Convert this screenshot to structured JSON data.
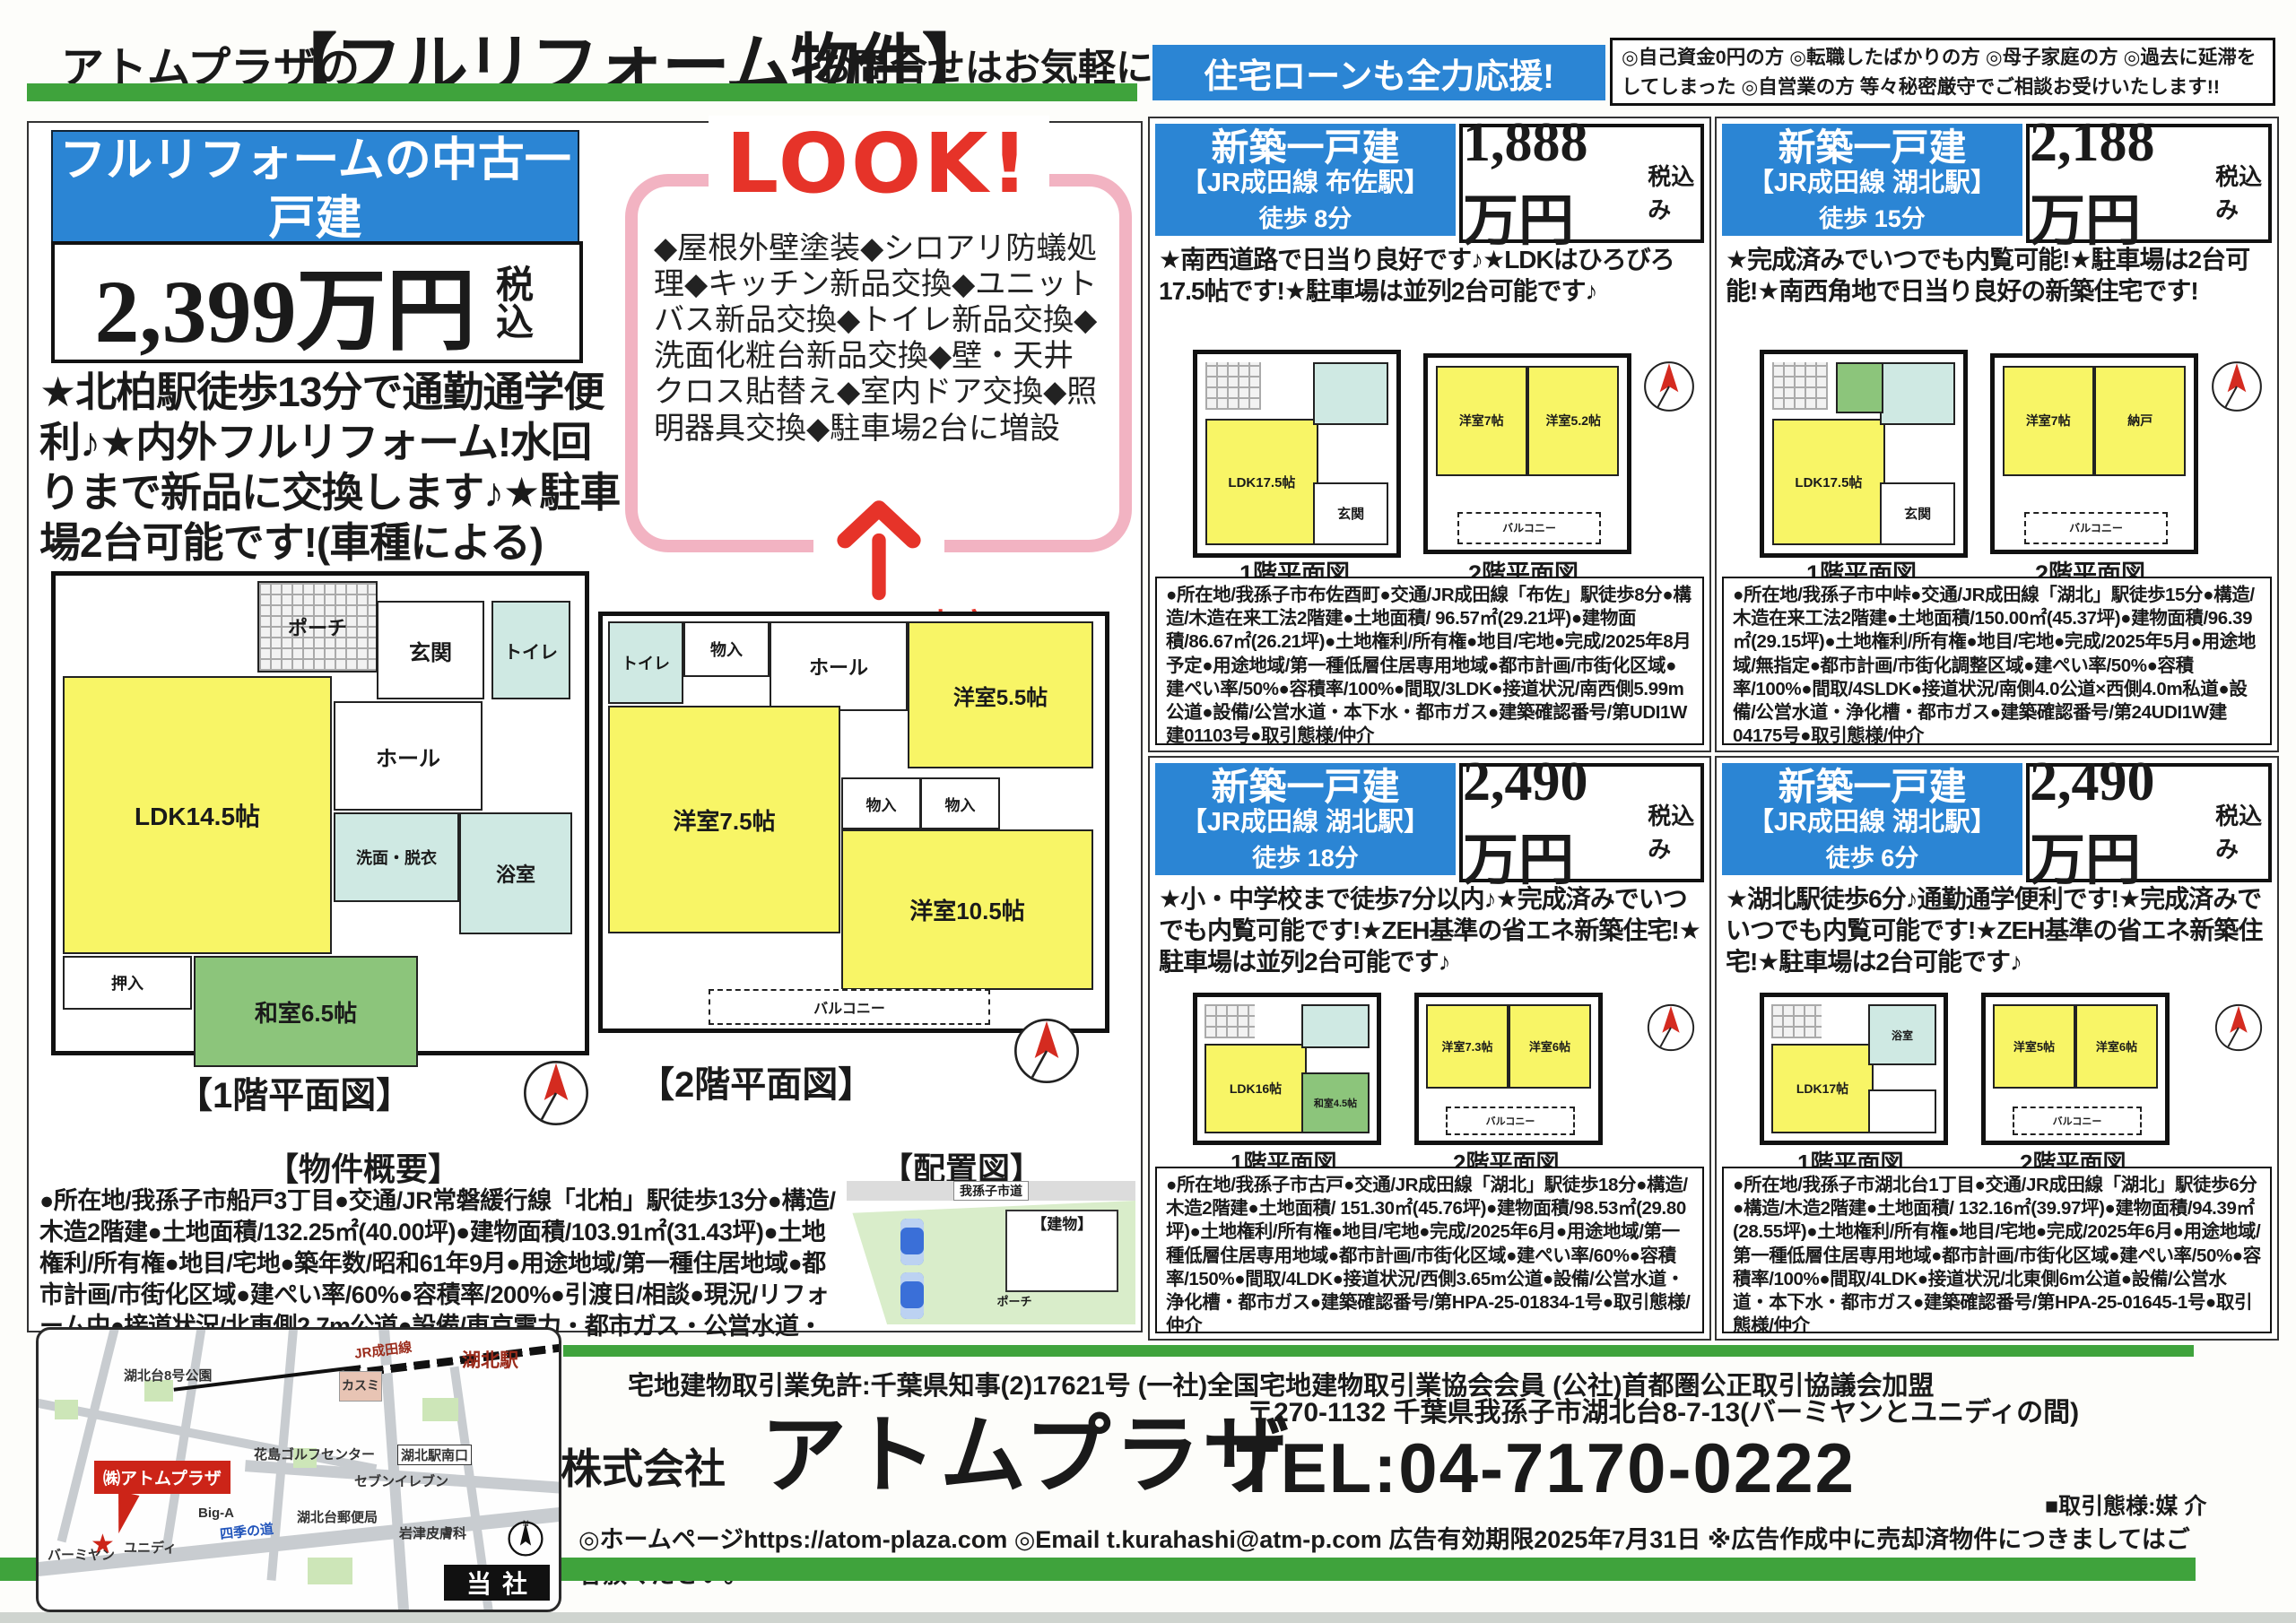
{
  "header": {
    "brand_prefix": "アトムプラザの",
    "title": "【フルリフォーム物件】",
    "subtitle": "お問合せはお気軽に!"
  },
  "loan_banner": {
    "label": "住宅ローンも全力応援!",
    "text": "◎自己資金0円の方 ◎転職したばかりの方 ◎母子家庭の方 ◎過去に延滞をしてしまった ◎自営業の方 等々秘密厳守でご相談お受けいたします!!"
  },
  "main_property": {
    "header": "フルリフォームの中古一戸建",
    "access": "【JR常磐緩行線 北柏駅 徒歩 13分】",
    "price": "2,399万円",
    "tax_note": "税込",
    "features": "★北柏駅徒歩13分で通勤通学便利♪★内外フルリフォーム!水回りまで新品に交換します♪★駐車場2台可能です!(車種による)",
    "look": {
      "badge": "LOOK!",
      "items": "◆屋根外壁塗装◆シロアリ防蟻処理◆キッチン新品交換◆ユニットバス新品交換◆トイレ新品交換◆洗面化粧台新品交換◆壁・天井クロス貼替え◆室内ドア交換◆照明器具交換◆駐車場2台に増設",
      "caption": "リフォーム内容!"
    },
    "floor1_label": "【1階平面図】",
    "floor2_label": "【2階平面図】",
    "overview_label": "【物件概要】",
    "layout_label": "【配置図】",
    "overview": "●所在地/我孫子市船戸3丁目●交通/JR常磐緩行線「北柏」駅徒歩13分●構造/木造2階建●土地面積/132.25㎡(40.00坪)●建物面積/103.91㎡(31.43坪)●土地権利/所有権●地目/宅地●築年数/昭和61年9月●用途地域/第一種住居地域●都市計画/市街化区域●建ぺい率/60%●容積率/200%●引渡日/相談●現況/リフォーム中●接道状況/北東側2.7m公道●設備/東京電力・都市ガス・公営水道・本下水●取引態様/仲介",
    "floor1_rooms": [
      "ポーチ",
      "玄関",
      "トイレ",
      "ホール",
      "LDK14.5帖",
      "洗面・脱衣",
      "浴室",
      "和室6.5帖",
      "押入"
    ],
    "floor2_rooms": [
      "トイレ",
      "物入",
      "ホール",
      "洋室5.5帖",
      "洋室7.5帖",
      "物入",
      "物入",
      "洋室10.5帖",
      "バルコニー"
    ],
    "site_road": "我孫子市道",
    "site_building": "【建物】",
    "site_porch": "ポーチ"
  },
  "listings": [
    {
      "type": "新築一戸建",
      "access": "【JR成田線 布佐駅】",
      "walk": "徒歩 8分",
      "price": "1,888万円",
      "tax": "税込み",
      "features": "★南西道路で日当り良好です♪★LDKはひろびろ17.5帖です!★駐車場は並列2台可能です♪",
      "floor1_label": "1階平面図",
      "floor2_label": "2階平面図",
      "rooms1": [
        "LDK17.5帖",
        "玄関"
      ],
      "rooms2": [
        "洋室7帖",
        "洋室5.2帖",
        "バルコニー"
      ],
      "details": "●所在地/我孫子市布佐酉町●交通/JR成田線「布佐」駅徒歩8分●構造/木造在来工法2階建●土地面積/ 96.57㎡(29.21坪)●建物面積/86.67㎡(26.21坪)●土地権利/所有権●地目/宅地●完成/2025年8月予定●用途地域/第一種低層住居専用地域●都市計画/市街化区域●建ぺい率/50%●容積率/100%●間取/3LDK●接道状況/南西側5.99m公道●設備/公営水道・本下水・都市ガス●建築確認番号/第UDI1W建01103号●取引態様/仲介"
    },
    {
      "type": "新築一戸建",
      "access": "【JR成田線 湖北駅】",
      "walk": "徒歩 15分",
      "price": "2,188万円",
      "tax": "税込み",
      "features": "★完成済みでいつでも内覧可能!★駐車場は2台可能!★南西角地で日当り良好の新築住宅です!",
      "floor1_label": "1階平面図",
      "floor2_label": "2階平面図",
      "rooms1": [
        "LDK17.5帖",
        "玄関"
      ],
      "rooms2": [
        "洋室7帖",
        "納戸",
        "バルコニー"
      ],
      "details": "●所在地/我孫子市中峠●交通/JR成田線「湖北」駅徒歩15分●構造/木造在来工法2階建●土地面積/150.00㎡(45.37坪)●建物面積/96.39㎡(29.15坪)●土地権利/所有権●地目/宅地●完成/2025年5月●用途地域/無指定●都市計画/市街化調整区域●建ぺい率/50%●容積率/100%●間取/4SLDK●接道状況/南側4.0公道×西側4.0m私道●設備/公営水道・浄化槽・都市ガス●建築確認番号/第24UDI1W建04175号●取引態様/仲介"
    },
    {
      "type": "新築一戸建",
      "access": "【JR成田線 湖北駅】",
      "walk": "徒歩 18分",
      "price": "2,490万円",
      "tax": "税込み",
      "features": "★小・中学校まで徒歩7分以内♪★完成済みでいつでも内覧可能です!★ZEH基準の省エネ新築住宅!★駐車場は並列2台可能です♪",
      "floor1_label": "1階平面図",
      "floor2_label": "2階平面図",
      "rooms1": [
        "LDK16帖",
        "和室4.5帖"
      ],
      "rooms2": [
        "洋室7.3帖",
        "洋室6帖",
        "バルコニー"
      ],
      "details": "●所在地/我孫子市古戸●交通/JR成田線「湖北」駅徒歩18分●構造/木造2階建●土地面積/ 151.30㎡(45.76坪)●建物面積/98.53㎡(29.80坪)●土地権利/所有権●地目/宅地●完成/2025年6月●用途地域/第一種低層住居専用地域●都市計画/市街化区域●建ぺい率/60%●容積率/150%●間取/4LDK●接道状況/西側3.65m公道●設備/公営水道・浄化槽・都市ガス●建築確認番号/第HPA-25-01834-1号●取引態様/仲介"
    },
    {
      "type": "新築一戸建",
      "access": "【JR成田線 湖北駅】",
      "walk": "徒歩 6分",
      "price": "2,490万円",
      "tax": "税込み",
      "features": "★湖北駅徒歩6分♪通勤通学便利です!★完成済みでいつでも内覧可能です!★ZEH基準の省エネ新築住宅!★駐車場は2台可能です♪",
      "floor1_label": "1階平面図",
      "floor2_label": "2階平面図",
      "rooms1": [
        "LDK17帖",
        "浴室"
      ],
      "rooms2": [
        "洋室5帖",
        "洋室6帖",
        "バルコニー"
      ],
      "details": "●所在地/我孫子市湖北台1丁目●交通/JR成田線「湖北」駅徒歩6分●構造/木造2階建●土地面積/ 132.16㎡(39.97坪)●建物面積/94.39㎡(28.55坪)●土地権利/所有権●地目/宅地●完成/2025年6月●用途地域/第一種低層住居専用地域●都市計画/市街化区域●建ぺい率/50%●容積率/100%●間取/4LDK●接道状況/北東側6m公道●設備/公営水道・本下水・都市ガス●建築確認番号/第HPA-25-01645-1号●取引態様/仲介"
    }
  ],
  "footer": {
    "license": "宅地建物取引業免許:千葉県知事(2)17621号 (一社)全国宅地建物取引業協会会員 (公社)首都圏公正取引協議会加盟",
    "company_prefix": "株式会社",
    "company_name": "アトムプラザ",
    "address": "〒270-1132 千葉県我孫子市湖北台8-7-13(バーミヤンとユニディの間)",
    "tel": "TEL:04-7170-0222",
    "deal_type": "■取引態様:媒 介",
    "web_email": "◎ホームページhttps://atom-plaza.com ◎Email t.kurahashi@atm-p.com 広告有効期限2025年7月31日 ※広告作成中に売却済物件につきましてはご容赦ください。"
  },
  "map": {
    "labels": [
      "湖北台8号公園",
      "JR成田線",
      "湖北駅",
      "カスミ",
      "花島ゴルフセンター",
      "湖北駅南口",
      "セブンイレブン",
      "Big-A",
      "四季の道",
      "湖北台郵便局",
      "岩津皮膚科",
      "バーミヤン",
      "ユニディ"
    ],
    "marker": "㈱アトムプラザ",
    "badge": "当社",
    "north": "N"
  },
  "colors": {
    "blue": "#2b85d4",
    "green": "#3fa33c",
    "red": "#e63329",
    "pink": "#f2b3c2",
    "room_yellow": "#f8f566",
    "room_cyan": "#cfe9e3",
    "tatami_green": "#8cc57b",
    "site_green": "#d9edca"
  }
}
